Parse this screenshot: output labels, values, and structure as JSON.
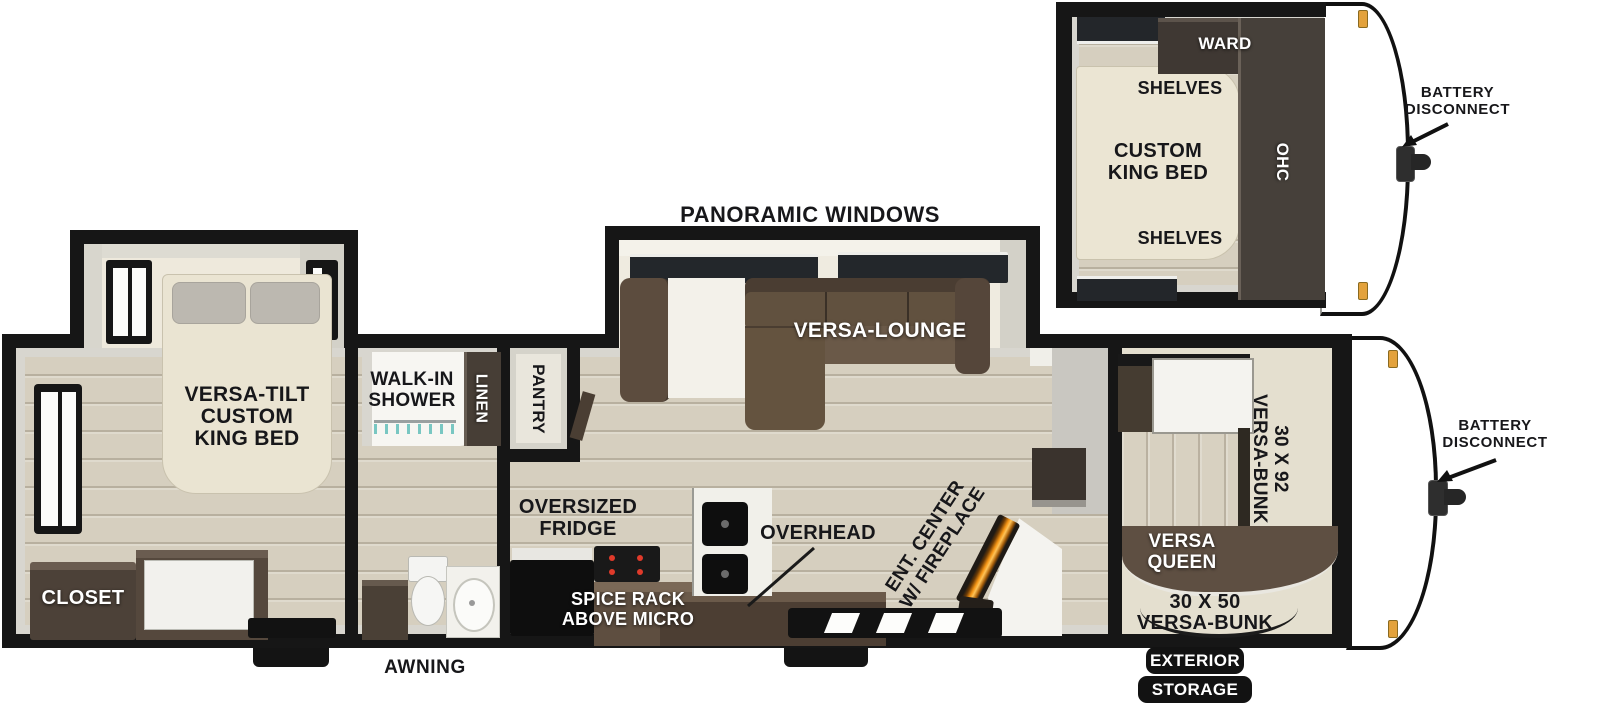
{
  "colors": {
    "wall": "#161616",
    "floor_wood": "#d6cfbf",
    "floor_cream": "#ebe7d9",
    "furniture_dark_brown": "#4c4138",
    "sofa_brown": "#5f5043",
    "bed_cream": "#eae4d2",
    "fireplace_glow": "#f49414",
    "marker_light": "#e3a23c",
    "label_black": "#17171a",
    "label_white": "#ffffff"
  },
  "inset": {
    "ward": "WARD",
    "shelves_top": "SHELVES",
    "shelves_bottom": "SHELVES",
    "bed_line1": "CUSTOM",
    "bed_line2": "KING BED",
    "ohc": "OHC",
    "battery_line1": "BATTERY",
    "battery_line2": "DISCONNECT"
  },
  "main": {
    "panoramic": "PANORAMIC WINDOWS",
    "bedroom": {
      "bed_line1": "VERSA-TILT",
      "bed_line2": "CUSTOM",
      "bed_line3": "KING BED",
      "closet": "CLOSET"
    },
    "bath": {
      "shower_line1": "WALK-IN",
      "shower_line2": "SHOWER",
      "linen": "LINEN"
    },
    "kitchen": {
      "pantry": "PANTRY",
      "fridge_line1": "OVERSIZED",
      "fridge_line2": "FRIDGE",
      "spice_line1": "SPICE RACK",
      "spice_line2": "ABOVE MICRO",
      "overhead": "OVERHEAD"
    },
    "living": {
      "lounge": "VERSA-LOUNGE",
      "ent_line1": "ENT. CENTER",
      "ent_line2": "W/ FIREPLACE"
    },
    "bunk": {
      "b92_line1": "30 X 92",
      "b92_line2": "VERSA-BUNK",
      "queen_line1": "VERSA",
      "queen_line2": "QUEEN",
      "b50_line1": "30 X 50",
      "b50_line2": "VERSA-BUNK"
    },
    "battery_line1": "BATTERY",
    "battery_line2": "DISCONNECT",
    "awning": "AWNING",
    "exterior_line1": "EXTERIOR",
    "exterior_line2": "STORAGE"
  }
}
